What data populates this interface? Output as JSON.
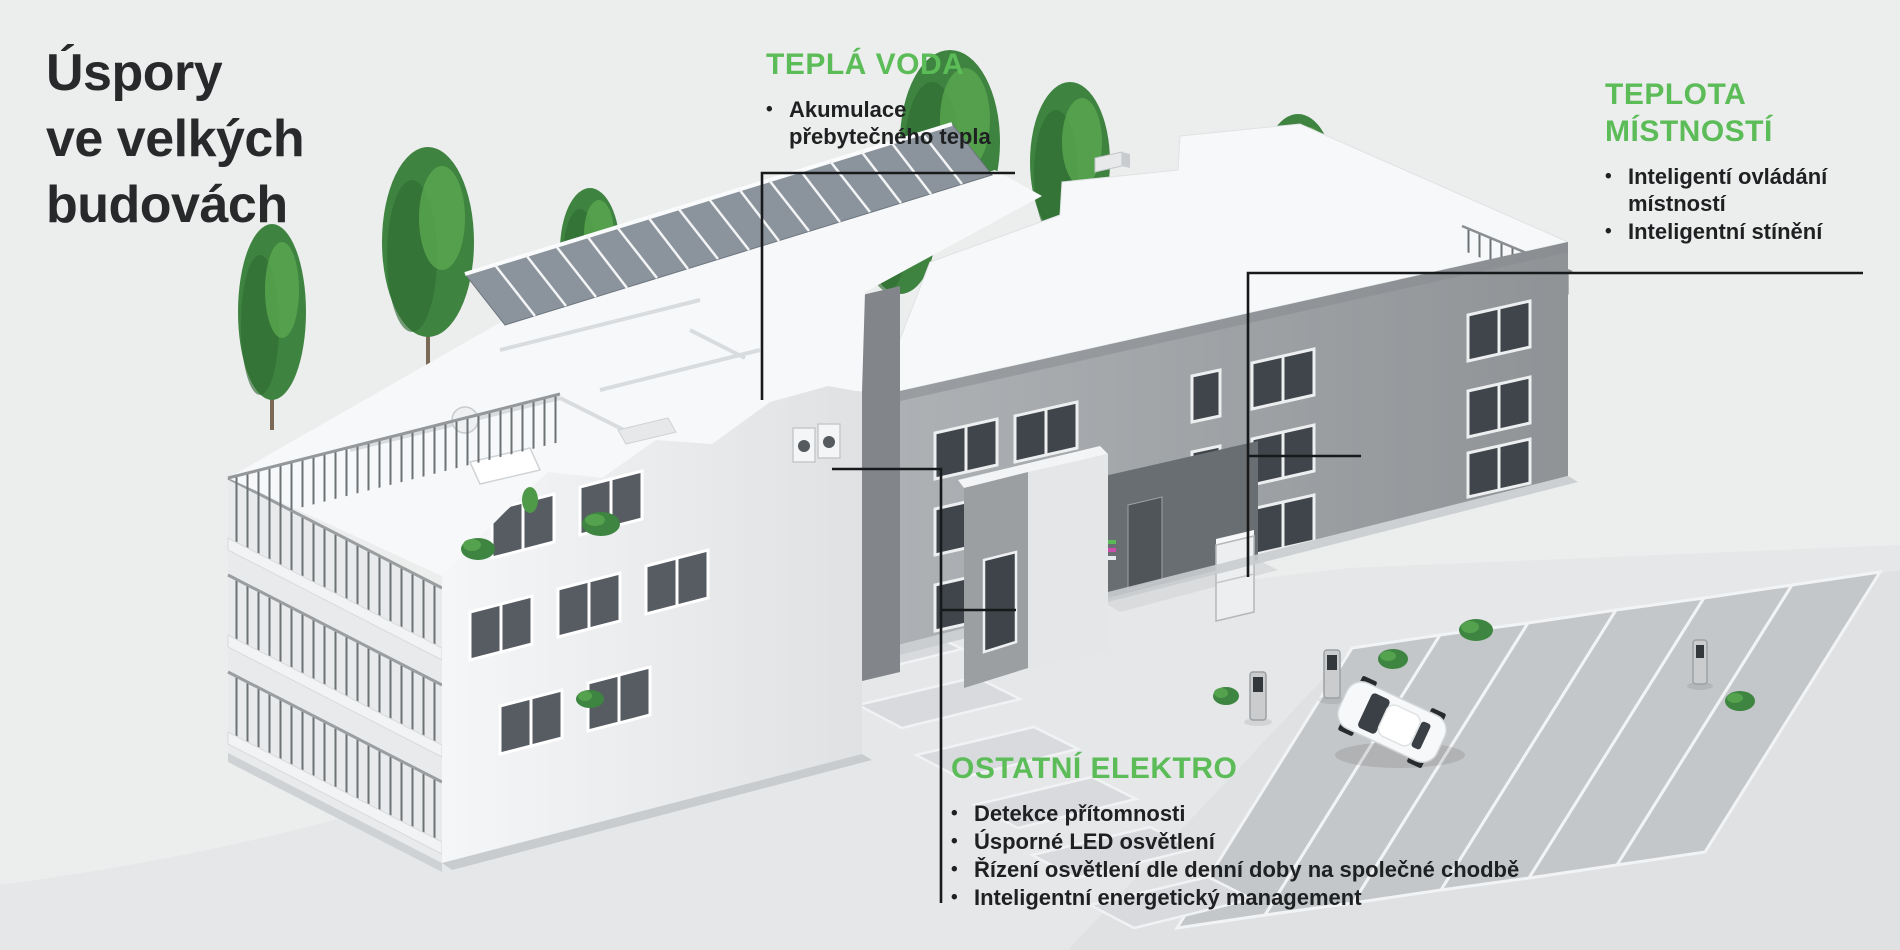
{
  "title": {
    "lines": [
      "Úspory",
      "ve velkých",
      "budovách"
    ]
  },
  "bullet_glyph": "•",
  "callouts": [
    {
      "id": "tepla-voda",
      "heading": "TEPLÁ VODA",
      "bullets": [
        "Akumulace přebytečného tepla"
      ]
    },
    {
      "id": "teplota-mistnosti",
      "heading": "TEPLOTA MÍSTNOSTÍ",
      "bullets": [
        "Inteligentí ovládání místností",
        "Inteligentní stínění"
      ]
    },
    {
      "id": "ostatni-elektro",
      "heading": "OSTATNÍ ELEKTRO",
      "bullets": [
        "Detekce přítomnosti",
        "Úsporné LED osvětlení",
        "Řízení osvětlení dle denní doby na společné chodbě",
        "Inteligentní energetický management"
      ]
    }
  ],
  "colors": {
    "accent_green": "#5bbc58",
    "title_text": "#28292b",
    "body_text": "#1e2021",
    "leader_line": "#17191a",
    "background": "#eceded"
  },
  "scene_elements": [
    "apartment-building-cutaway",
    "solar-panels",
    "trees",
    "balconies",
    "parking-lot",
    "electric-car",
    "ev-chargers",
    "heat-pump",
    "entrance-door",
    "walkway-tiles",
    "bushes"
  ]
}
